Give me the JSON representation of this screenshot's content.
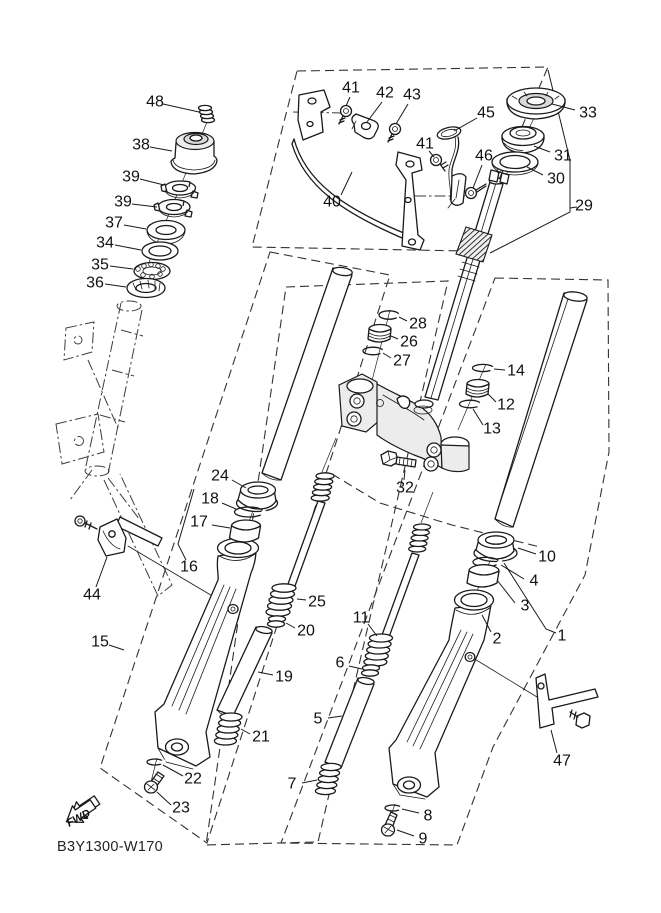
{
  "diagram": {
    "code": "B3Y1300-W170",
    "fwd": "FWD",
    "ink_color": "#1a1a1a",
    "background_color": "#ffffff",
    "callouts": [
      {
        "n": "48",
        "x": 155,
        "y": 102,
        "x1": 163,
        "y1": 104,
        "x2": 199,
        "y2": 112
      },
      {
        "n": "38",
        "x": 141,
        "y": 145,
        "x1": 150,
        "y1": 147,
        "x2": 172,
        "y2": 151
      },
      {
        "n": "39",
        "x": 131,
        "y": 177,
        "x1": 140,
        "y1": 179,
        "x2": 164,
        "y2": 185
      },
      {
        "n": "39",
        "x": 123,
        "y": 202,
        "x1": 132,
        "y1": 204,
        "x2": 157,
        "y2": 207
      },
      {
        "n": "37",
        "x": 114,
        "y": 223,
        "x1": 124,
        "y1": 225,
        "x2": 146,
        "y2": 229
      },
      {
        "n": "34",
        "x": 105,
        "y": 243,
        "x1": 115,
        "y1": 245,
        "x2": 141,
        "y2": 250
      },
      {
        "n": "35",
        "x": 100,
        "y": 265,
        "x1": 110,
        "y1": 266,
        "x2": 133,
        "y2": 269
      },
      {
        "n": "36",
        "x": 95,
        "y": 283,
        "x1": 105,
        "y1": 284,
        "x2": 126,
        "y2": 287
      },
      {
        "n": "41",
        "x": 351,
        "y": 88,
        "x1": 350,
        "y1": 97,
        "x2": 346,
        "y2": 106
      },
      {
        "n": "42",
        "x": 385,
        "y": 93,
        "x1": 382,
        "y1": 102,
        "x2": 367,
        "y2": 122
      },
      {
        "n": "43",
        "x": 412,
        "y": 95,
        "x1": 408,
        "y1": 104,
        "x2": 396,
        "y2": 124
      },
      {
        "n": "45",
        "x": 486,
        "y": 113,
        "x1": 477,
        "y1": 118,
        "x2": 454,
        "y2": 131
      },
      {
        "n": "41",
        "x": 425,
        "y": 144,
        "x1": 429,
        "y1": 151,
        "x2": 434,
        "y2": 157
      },
      {
        "n": "46",
        "x": 484,
        "y": 156,
        "x1": 482,
        "y1": 165,
        "x2": 473,
        "y2": 188
      },
      {
        "n": "40",
        "x": 332,
        "y": 202,
        "x1": 341,
        "y1": 195,
        "x2": 352,
        "y2": 172
      },
      {
        "n": "33",
        "x": 588,
        "y": 113,
        "x1": 575,
        "y1": 110,
        "x2": 552,
        "y2": 104
      },
      {
        "n": "31",
        "x": 563,
        "y": 156,
        "x1": 550,
        "y1": 152,
        "x2": 534,
        "y2": 146
      },
      {
        "n": "30",
        "x": 556,
        "y": 179,
        "x1": 543,
        "y1": 175,
        "x2": 527,
        "y2": 167
      },
      {
        "n": "29",
        "x": 584,
        "y": 206,
        "x1": 577,
        "y1": 207,
        "x2": 570,
        "y2": 208
      },
      {
        "n": "28",
        "x": 418,
        "y": 324,
        "x1": 407,
        "y1": 321,
        "x2": 399,
        "y2": 317
      },
      {
        "n": "26",
        "x": 409,
        "y": 342,
        "x1": 398,
        "y1": 339,
        "x2": 391,
        "y2": 336
      },
      {
        "n": "27",
        "x": 402,
        "y": 361,
        "x1": 391,
        "y1": 358,
        "x2": 383,
        "y2": 353
      },
      {
        "n": "14",
        "x": 516,
        "y": 371,
        "x1": 505,
        "y1": 370,
        "x2": 494,
        "y2": 369
      },
      {
        "n": "12",
        "x": 506,
        "y": 405,
        "x1": 496,
        "y1": 402,
        "x2": 488,
        "y2": 394
      },
      {
        "n": "13",
        "x": 492,
        "y": 429,
        "x1": 483,
        "y1": 425,
        "x2": 473,
        "y2": 409
      },
      {
        "n": "32",
        "x": 405,
        "y": 488,
        "x1": 404,
        "y1": 480,
        "x2": 405,
        "y2": 470
      },
      {
        "n": "24",
        "x": 220,
        "y": 476,
        "x1": 232,
        "y1": 480,
        "x2": 246,
        "y2": 488
      },
      {
        "n": "18",
        "x": 210,
        "y": 499,
        "x1": 222,
        "y1": 503,
        "x2": 236,
        "y2": 509
      },
      {
        "n": "17",
        "x": 199,
        "y": 522,
        "x1": 212,
        "y1": 525,
        "x2": 230,
        "y2": 528
      },
      {
        "n": "16",
        "x": 189,
        "y": 567
      },
      {
        "n": "44",
        "x": 92,
        "y": 595,
        "x1": 96,
        "y1": 587,
        "x2": 107,
        "y2": 557
      },
      {
        "n": "15",
        "x": 100,
        "y": 642,
        "x1": 109,
        "y1": 645,
        "x2": 124,
        "y2": 650
      },
      {
        "n": "25",
        "x": 317,
        "y": 602,
        "x1": 306,
        "y1": 600,
        "x2": 297,
        "y2": 599
      },
      {
        "n": "20",
        "x": 306,
        "y": 631,
        "x1": 295,
        "y1": 628,
        "x2": 286,
        "y2": 623
      },
      {
        "n": "19",
        "x": 284,
        "y": 677,
        "x1": 273,
        "y1": 675,
        "x2": 258,
        "y2": 672
      },
      {
        "n": "21",
        "x": 261,
        "y": 737,
        "x1": 250,
        "y1": 734,
        "x2": 241,
        "y2": 729
      },
      {
        "n": "22",
        "x": 193,
        "y": 779,
        "x1": 183,
        "y1": 776,
        "x2": 163,
        "y2": 765
      },
      {
        "n": "23",
        "x": 181,
        "y": 808,
        "x1": 171,
        "y1": 805,
        "x2": 157,
        "y2": 792
      },
      {
        "n": "11",
        "x": 361,
        "y": 618,
        "x1": 368,
        "y1": 624,
        "x2": 377,
        "y2": 636
      },
      {
        "n": "6",
        "x": 340,
        "y": 663,
        "x1": 349,
        "y1": 666,
        "x2": 362,
        "y2": 669
      },
      {
        "n": "5",
        "x": 318,
        "y": 719,
        "x1": 328,
        "y1": 718,
        "x2": 342,
        "y2": 716
      },
      {
        "n": "7",
        "x": 292,
        "y": 784,
        "x1": 302,
        "y1": 783,
        "x2": 317,
        "y2": 780
      },
      {
        "n": "10",
        "x": 547,
        "y": 557,
        "x1": 536,
        "y1": 554,
        "x2": 518,
        "y2": 548
      },
      {
        "n": "4",
        "x": 534,
        "y": 581,
        "x1": 524,
        "y1": 579,
        "x2": 501,
        "y2": 565
      },
      {
        "n": "3",
        "x": 525,
        "y": 606,
        "x1": 515,
        "y1": 603,
        "x2": 497,
        "y2": 580
      },
      {
        "n": "2",
        "x": 497,
        "y": 639,
        "x1": 491,
        "y1": 632,
        "x2": 482,
        "y2": 615
      },
      {
        "n": "1",
        "x": 562,
        "y": 636
      },
      {
        "n": "47",
        "x": 562,
        "y": 761,
        "x1": 557,
        "y1": 753,
        "x2": 551,
        "y2": 730
      },
      {
        "n": "8",
        "x": 428,
        "y": 816,
        "x1": 419,
        "y1": 813,
        "x2": 402,
        "y2": 809
      },
      {
        "n": "9",
        "x": 423,
        "y": 839,
        "x1": 414,
        "y1": 836,
        "x2": 397,
        "y2": 830
      }
    ]
  }
}
